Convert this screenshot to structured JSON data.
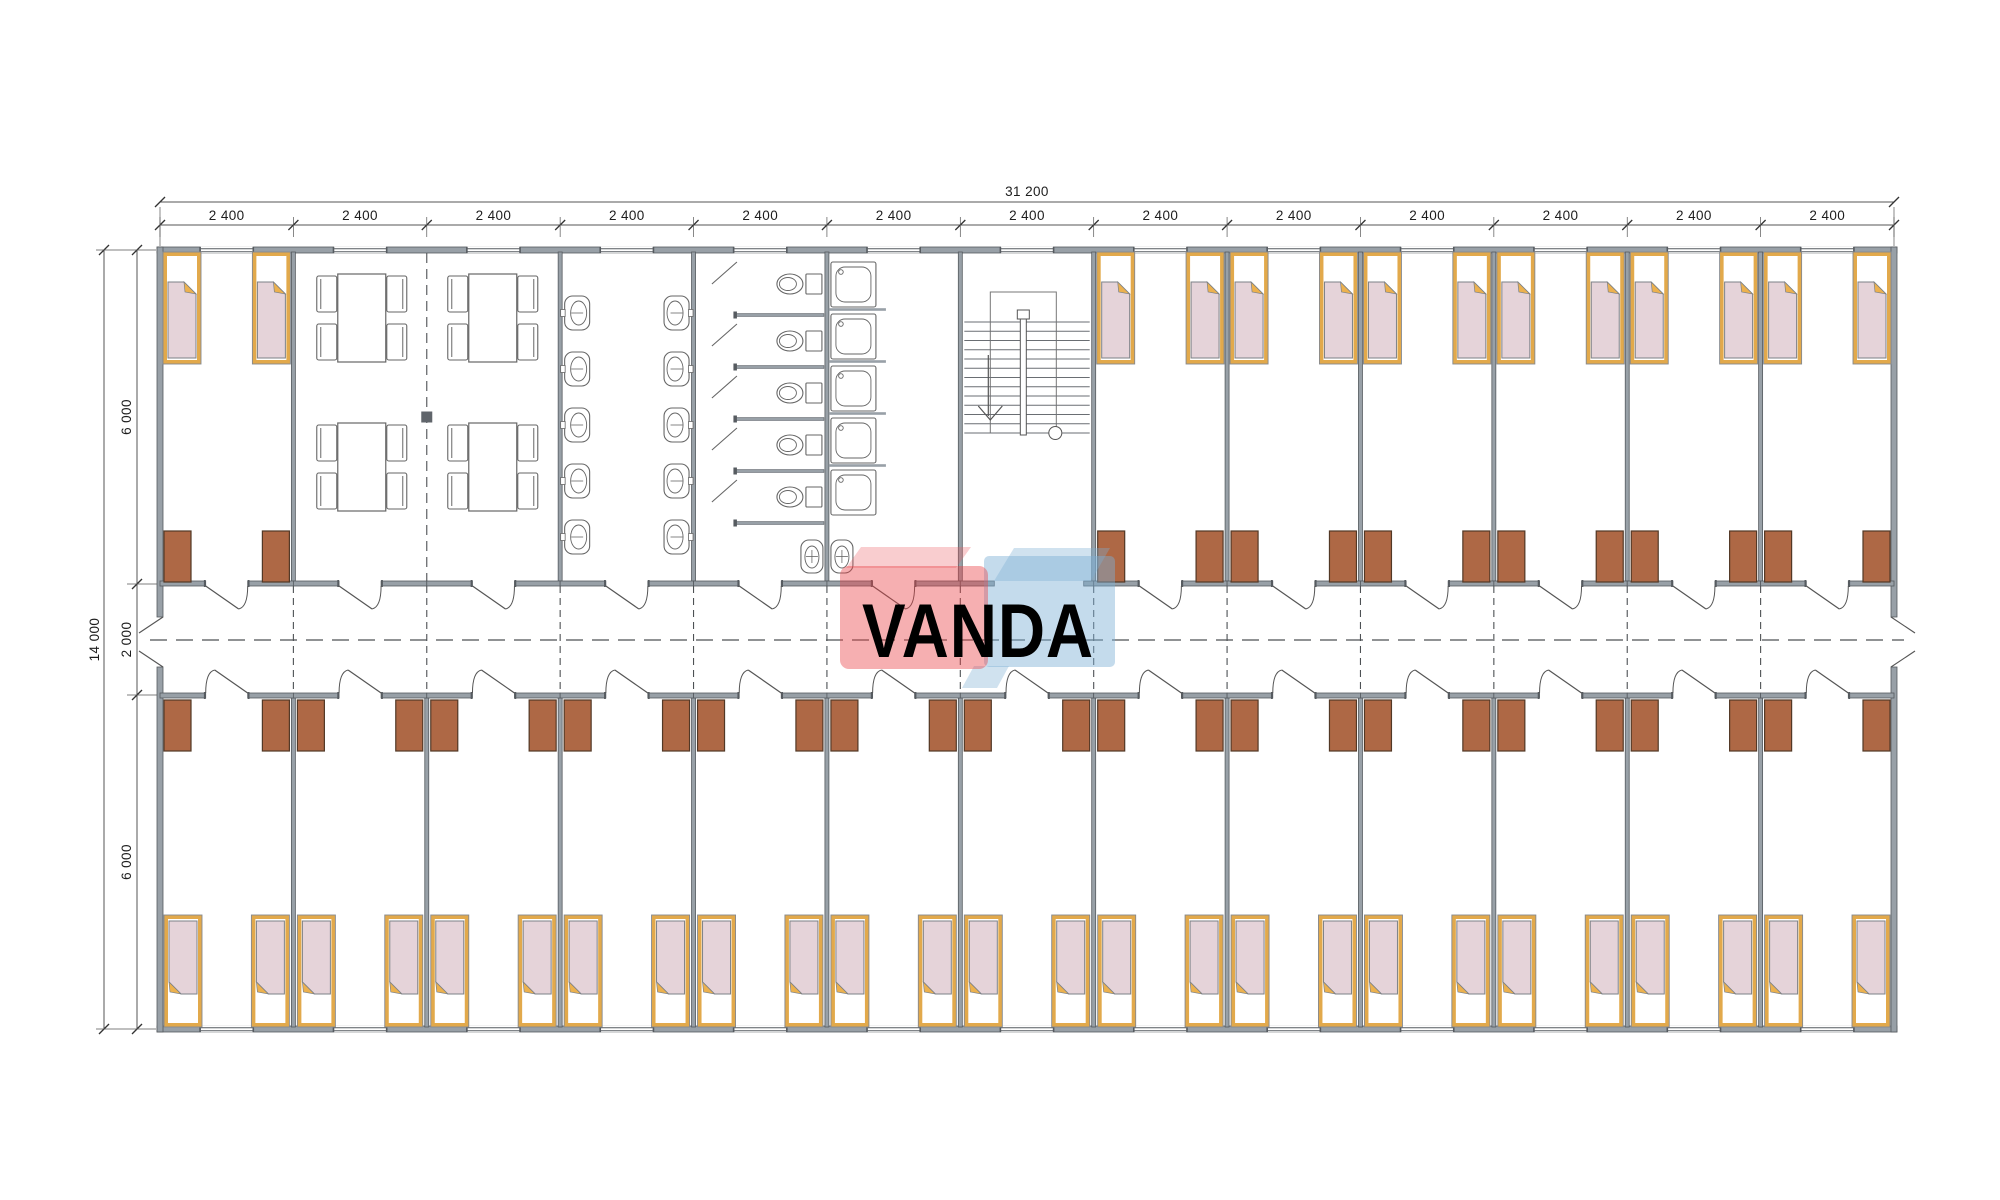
{
  "logo": {
    "text": "VANDA",
    "red": "rgba(233,64,70,0.42)",
    "red_light": "rgba(236,90,96,0.30)",
    "blue": "rgba(125,176,212,0.45)",
    "blue_light": "rgba(125,176,212,0.36)",
    "text_color": "rgba(255,255,255,0.93)"
  },
  "dimensions": {
    "total_width": "31 200",
    "bays": [
      "2 400",
      "2 400",
      "2 400",
      "2 400",
      "2 400",
      "2 400",
      "2 400",
      "2 400",
      "2 400",
      "2 400",
      "2 400",
      "2 400",
      "2 400"
    ],
    "total_height": "14 000",
    "height_segments": [
      "6 000",
      "2 000",
      "6 000"
    ]
  },
  "colors": {
    "wall": "#98a0a7",
    "wall_stroke": "#565b60",
    "line": "#5a5e63",
    "dash": "#4d5154",
    "dim_line": "#555555",
    "dim_text": "#1d1d1d",
    "bed_frame": "#e2a94b",
    "bed_outline": "#85898f",
    "mattress": "#e5d3d9",
    "mattress_stroke": "#7c8187",
    "fold": "#ecb14e",
    "wardrobe": "#ae6845",
    "wardrobe_stroke": "#523826",
    "fixture": "#666b70",
    "white": "#ffffff"
  },
  "layout": {
    "plan": {
      "x": 160,
      "y": 250,
      "w": 1734,
      "h": 779
    },
    "bay_count": 13,
    "corridor": {
      "top_wall_y": 581,
      "bottom_wall_y": 693,
      "center_y": 640,
      "end_gap_top": 617,
      "end_gap_bottom": 667
    },
    "zones": {
      "top_y1": 252,
      "top_y2": 581,
      "bottom_y1": 698,
      "bottom_y2": 1027
    },
    "rooms_top": {
      "bedroom_bays": [
        0,
        7,
        8,
        9,
        10,
        11,
        12
      ],
      "dining_bays": [
        1,
        2
      ],
      "washroom_bay": 3,
      "wc_bay": 4,
      "shower_bay": 5,
      "stair_bay": 6
    },
    "door_opening_w": 42,
    "window_w": 52,
    "counts": {
      "beds_top": 14,
      "beds_bottom": 26,
      "wardrobes": 40,
      "tables": 4,
      "chairs_per_table": 4,
      "wash_basins": 10,
      "corner_basins": 2,
      "wc_stalls": 5,
      "showers": 5
    }
  }
}
